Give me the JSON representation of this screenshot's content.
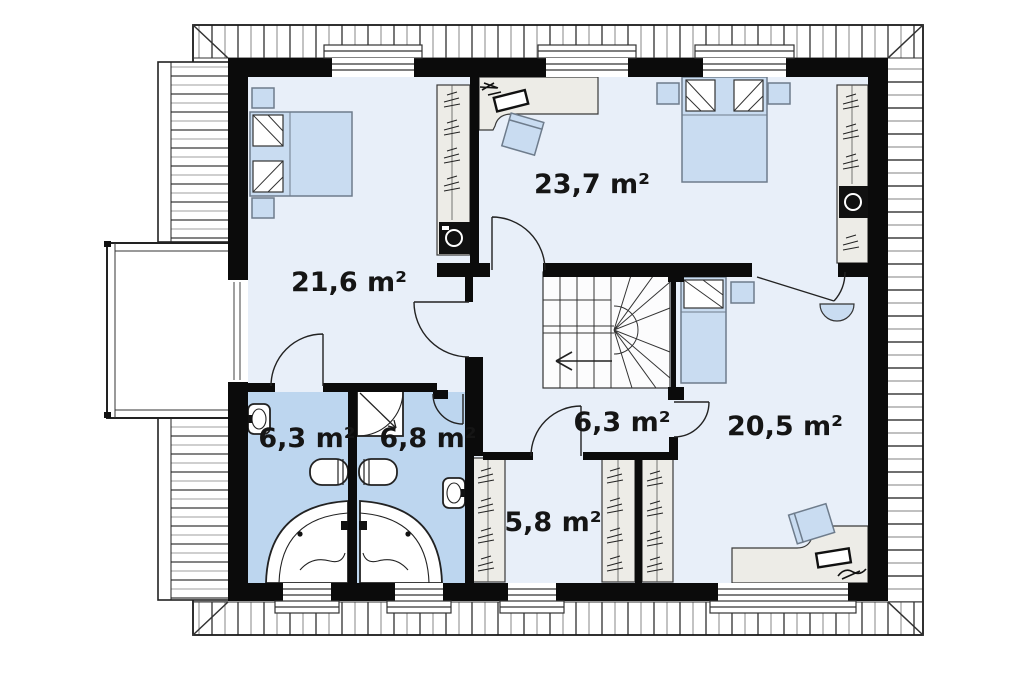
{
  "plan": {
    "drawing_type": "floor-plan",
    "rooms": [
      {
        "name": "bedroom-left",
        "area_label": "21,6 m²"
      },
      {
        "name": "bedroom-top-right",
        "area_label": "23,7 m²"
      },
      {
        "name": "bathroom-left",
        "area_label": "6,3 m²"
      },
      {
        "name": "bathroom-right",
        "area_label": "6,8 m²"
      },
      {
        "name": "hallway",
        "area_label": "6,3 m²"
      },
      {
        "name": "wardrobe-room",
        "area_label": "5,8 m²"
      },
      {
        "name": "bedroom-bottom-right",
        "area_label": "20,5 m²"
      }
    ],
    "fixtures": [
      "double-bed",
      "single-bed",
      "wardrobe",
      "desk",
      "office-chair",
      "washing-machine",
      "winder-staircase",
      "corner-bathtub",
      "shower-cabin",
      "toilet",
      "washbasin",
      "balcony",
      "roof-eaves"
    ],
    "colors": {
      "wall": "#0b0b0b",
      "room_fill": "#e8eff9",
      "bathroom_fill": "#bdd6ef",
      "furniture_fill": "#c9dcf1",
      "cabinet_fill": "#edece7",
      "hatch_dark": "#3f3f3f",
      "hatch_light": "#9b9b9b"
    }
  }
}
